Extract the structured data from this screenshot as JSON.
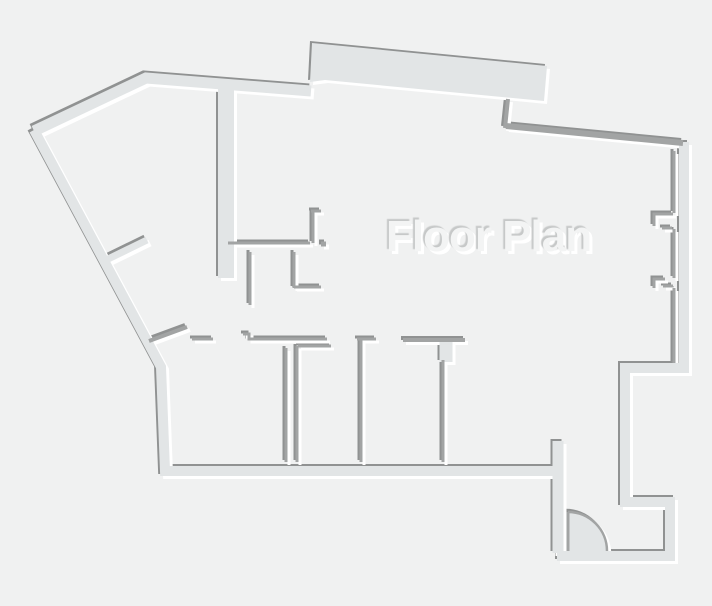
{
  "title": "Floor Plan",
  "canvas": {
    "width": 712,
    "height": 606
  },
  "colors": {
    "background": "#f0f1f1",
    "wall_fill": "#e2e5e6",
    "thin_wall": "#a2a4a4",
    "shadow_dark": "#909292",
    "shadow_light": "#ffffff",
    "text_fill": "#f3f4f4",
    "text_shadow_dark": "#c6c8c8"
  },
  "walls": {
    "bands": [
      {
        "name": "outer-left-and-bottom",
        "width": 10,
        "points": [
          [
            557,
            471
          ],
          [
            165,
            471
          ],
          [
            161,
            367
          ],
          [
            34,
            130
          ]
        ]
      },
      {
        "name": "outer-top-left",
        "width": 11,
        "points": [
          [
            34,
            131
          ],
          [
            146,
            78
          ],
          [
            311,
            91
          ]
        ]
      },
      {
        "name": "outer-right-stepped",
        "width": 10,
        "points": [
          [
            684,
            142
          ],
          [
            684,
            368
          ],
          [
            625,
            368
          ],
          [
            625,
            502
          ],
          [
            670,
            502
          ],
          [
            670,
            556
          ],
          [
            557,
            556
          ]
        ]
      },
      {
        "name": "vestibule-left",
        "width": 11,
        "points": [
          [
            558,
            441
          ],
          [
            558,
            553
          ]
        ]
      },
      {
        "name": "corridor-wall",
        "width": 16,
        "points": [
          [
            226,
            82
          ],
          [
            226,
            278
          ]
        ]
      },
      {
        "name": "hall-branch-wall",
        "width": 7,
        "points": [
          [
            104,
            261
          ],
          [
            147,
            240
          ]
        ]
      },
      {
        "name": "room4-door-stub",
        "width": 13,
        "points": [
          [
            446,
            342
          ],
          [
            446,
            362
          ]
        ]
      }
    ],
    "polygons": [
      {
        "name": "top-terrace-slab",
        "points": [
          [
            312,
            43
          ],
          [
            547,
            66
          ],
          [
            544,
            101
          ],
          [
            325,
            80
          ],
          [
            310,
            82
          ]
        ]
      }
    ],
    "thin": [
      {
        "name": "terrace-notch",
        "width": 4,
        "points": [
          [
            508,
            99
          ],
          [
            505,
            128
          ]
        ]
      },
      {
        "name": "top-right-wall",
        "width": 6,
        "points": [
          [
            506,
            126
          ],
          [
            683,
            143
          ]
        ]
      },
      {
        "name": "hall-wall",
        "width": 3,
        "points": [
          [
            228,
            243
          ],
          [
            310,
            243
          ]
        ]
      },
      {
        "name": "jamb-top-h",
        "width": 3,
        "points": [
          [
            311,
            211
          ],
          [
            321,
            211
          ]
        ]
      },
      {
        "name": "jamb-top-v",
        "width": 3,
        "points": [
          [
            313,
            212
          ],
          [
            313,
            243
          ]
        ]
      },
      {
        "name": "jamb-dot",
        "width": 5,
        "points": [
          [
            321,
            244
          ],
          [
            326,
            244
          ]
        ]
      },
      {
        "name": "ell-wall-v",
        "width": 3,
        "points": [
          [
            294,
            252
          ],
          [
            294,
            288
          ]
        ]
      },
      {
        "name": "ell-wall-h",
        "width": 3,
        "points": [
          [
            294,
            287
          ],
          [
            321,
            287
          ]
        ]
      },
      {
        "name": "hall-stub-wall",
        "width": 3,
        "points": [
          [
            250,
            252
          ],
          [
            250,
            305
          ]
        ]
      },
      {
        "name": "room1-top-left",
        "width": 3,
        "points": [
          [
            192,
            339
          ],
          [
            213,
            339
          ]
        ]
      },
      {
        "name": "room1-top-right",
        "width": 3,
        "points": [
          [
            243,
            334
          ],
          [
            249,
            334
          ],
          [
            249,
            339
          ],
          [
            327,
            339
          ]
        ]
      },
      {
        "name": "room2-top",
        "width": 3,
        "points": [
          [
            298,
            346
          ],
          [
            331,
            346
          ]
        ]
      },
      {
        "name": "divider1-left",
        "width": 3,
        "points": [
          [
            286,
            348
          ],
          [
            286,
            462
          ]
        ]
      },
      {
        "name": "divider1-right",
        "width": 3,
        "points": [
          [
            297,
            346
          ],
          [
            297,
            462
          ]
        ]
      },
      {
        "name": "room3-top-hook",
        "width": 3,
        "points": [
          [
            376,
            339
          ],
          [
            357,
            339
          ]
        ]
      },
      {
        "name": "divider2",
        "width": 3,
        "points": [
          [
            361,
            340
          ],
          [
            361,
            462
          ]
        ]
      },
      {
        "name": "room4-top",
        "width": 4,
        "points": [
          [
            403,
            340
          ],
          [
            465,
            340
          ]
        ]
      },
      {
        "name": "divider3",
        "width": 3,
        "points": [
          [
            443,
            360
          ],
          [
            443,
            462
          ]
        ]
      },
      {
        "name": "window-line-upper",
        "width": 3,
        "points": [
          [
            674,
            151
          ],
          [
            674,
            213
          ]
        ]
      },
      {
        "name": "window-line-mid",
        "width": 3,
        "points": [
          [
            674,
            229
          ],
          [
            674,
            278
          ]
        ]
      },
      {
        "name": "window-line-lower",
        "width": 3,
        "points": [
          [
            674,
            288
          ],
          [
            674,
            363
          ]
        ]
      },
      {
        "name": "window-jamb1",
        "width": 3,
        "points": [
          [
            673,
            214
          ],
          [
            654,
            214
          ],
          [
            654,
            226
          ]
        ]
      },
      {
        "name": "window-jamb1-tick",
        "width": 3,
        "points": [
          [
            662,
            228
          ],
          [
            672,
            228
          ]
        ]
      },
      {
        "name": "window-jamb2",
        "width": 3,
        "points": [
          [
            665,
            279
          ],
          [
            654,
            279
          ],
          [
            654,
            288
          ]
        ]
      },
      {
        "name": "window-jamb2-tick",
        "width": 3,
        "points": [
          [
            663,
            286
          ],
          [
            673,
            286
          ]
        ]
      },
      {
        "name": "left-door-leaf",
        "width": 4,
        "points": [
          [
            149,
            341
          ],
          [
            187,
            327
          ]
        ]
      }
    ],
    "door": {
      "name": "entry-door",
      "hinge": [
        568,
        551
      ],
      "radius": 39,
      "leaf_from": [
        568,
        512
      ],
      "leaf_to": [
        568,
        551
      ],
      "arc_from": [
        568,
        512
      ],
      "arc_to": [
        607,
        551
      ],
      "leaf_width": 3,
      "arc_width": 2.5
    }
  },
  "label": {
    "x": 386,
    "y": 212,
    "font_size": 44
  }
}
